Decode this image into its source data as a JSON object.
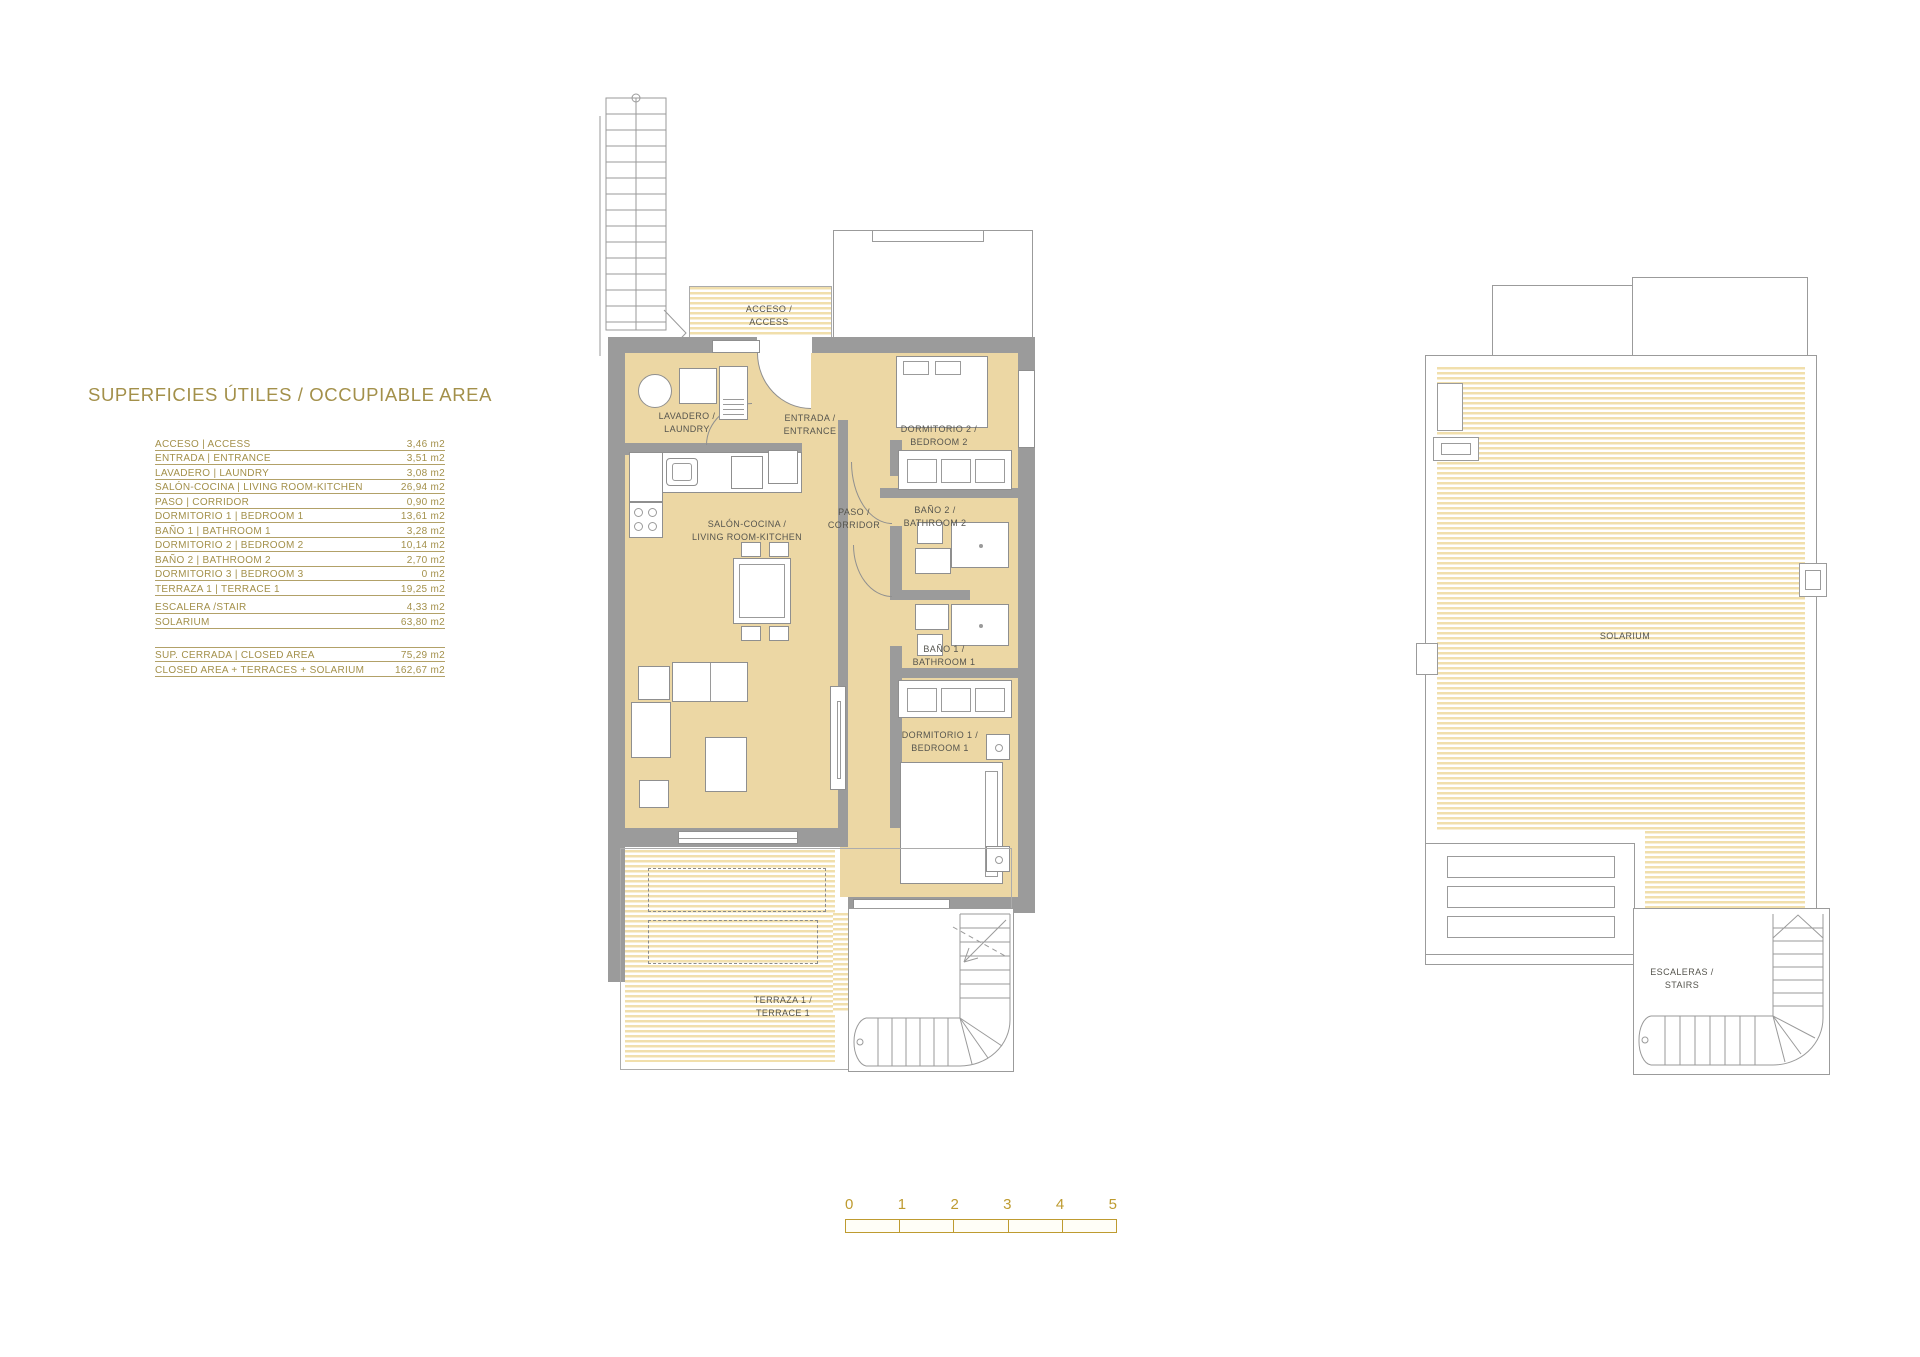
{
  "title": "SUPERFICIES ÚTILES / OCCUPIABLE AREA",
  "area_table": {
    "rows": [
      {
        "label": "ACCESO | ACCESS",
        "value": "3,46 m2"
      },
      {
        "label": "ENTRADA | ENTRANCE",
        "value": "3,51 m2"
      },
      {
        "label": "LAVADERO | LAUNDRY",
        "value": "3,08 m2"
      },
      {
        "label": "SALÓN-COCINA | LIVING ROOM-KITCHEN",
        "value": "26,94 m2"
      },
      {
        "label": "PASO | CORRIDOR",
        "value": "0,90 m2"
      },
      {
        "label": "DORMITORIO 1 | BEDROOM 1",
        "value": "13,61 m2"
      },
      {
        "label": "BAÑO 1 | BATHROOM 1",
        "value": "3,28 m2"
      },
      {
        "label": "DORMITORIO 2 | BEDROOM 2",
        "value": "10,14 m2"
      },
      {
        "label": "BAÑO 2 | BATHROOM 2",
        "value": "2,70 m2"
      },
      {
        "label": "DORMITORIO 3 | BEDROOM 3",
        "value": "0 m2"
      },
      {
        "label": "TERRAZA 1 | TERRACE 1",
        "value": "19,25 m2"
      },
      {
        "label": "ESCALERA /STAIR",
        "value": "4,33 m2"
      },
      {
        "label": "SOLARIUM",
        "value": "63,80 m2"
      }
    ],
    "summary_rows": [
      {
        "label": "SUP. CERRADA | CLOSED AREA",
        "value": "75,29 m2"
      },
      {
        "label": "CLOSED AREA + TERRACES + SOLARIUM",
        "value": "162,67 m2"
      }
    ]
  },
  "floor_plan": {
    "labels": {
      "acceso": [
        "ACCESO /",
        "ACCESS"
      ],
      "lavadero": [
        "LAVADERO /",
        "LAUNDRY"
      ],
      "entrada": [
        "ENTRADA /",
        "ENTRANCE"
      ],
      "dormitorio2": [
        "DORMITORIO 2 /",
        "BEDROOM 2"
      ],
      "paso": [
        "PASO /",
        "CORRIDOR"
      ],
      "bano2": [
        "BAÑO 2 /",
        "BATHROOM 2"
      ],
      "salon": [
        "SALÓN-COCINA /",
        "LIVING ROOM-KITCHEN"
      ],
      "bano1": [
        "BAÑO 1 /",
        "BATHROOM 1"
      ],
      "dormitorio1": [
        "DORMITORIO 1 /",
        "BEDROOM 1"
      ],
      "terraza1": [
        "TERRAZA 1 /",
        "TERRACE 1"
      ],
      "solarium": [
        "SOLARIUM"
      ],
      "escaleras": [
        "ESCALERAS /",
        "STAIRS"
      ]
    }
  },
  "scale_bar": {
    "ticks": [
      "0",
      "1",
      "2",
      "3",
      "4",
      "5"
    ]
  },
  "colors": {
    "accent_gold": "#A3904A",
    "scale_gold": "#BE9B30",
    "room_fill": "#ECD7A4",
    "hatch_stripe": "#F1DFAC",
    "wall_gray": "#9B9B9B"
  }
}
